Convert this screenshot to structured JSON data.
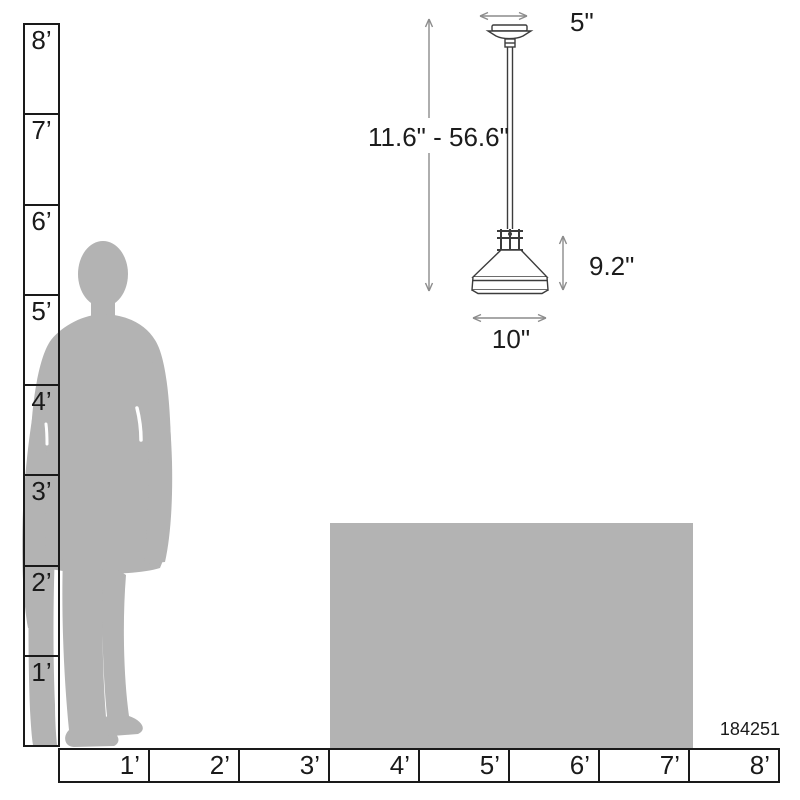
{
  "diagram": {
    "type": "product-scale-dimensions",
    "product": {
      "kind": "pendant-light-fixture",
      "model_number": "184251"
    },
    "annotations": {
      "canopy_width": "5\"",
      "hanging_height_range": "11.6\" - 56.6\"",
      "shade_height": "9.2\"",
      "shade_width": "10\""
    },
    "rulers": {
      "unit": "feet",
      "vertical": {
        "labels": [
          "8’",
          "7’",
          "6’",
          "5’",
          "4’",
          "3’",
          "2’",
          "1’"
        ],
        "range_feet": [
          0,
          8
        ]
      },
      "horizontal": {
        "labels": [
          "1’",
          "2’",
          "3’",
          "4’",
          "5’",
          "6’",
          "7’",
          "8’"
        ],
        "range_feet": [
          0,
          8
        ]
      }
    },
    "reference_figures": {
      "person": "standing-man-silhouette",
      "box": "scale-reference-box"
    },
    "colors": {
      "background": "#ffffff",
      "ruler_line": "#1a1a1a",
      "silhouette_gray": "#b3b3b3",
      "fixture_line": "#3c3c3c",
      "dimension_line": "#8c8c8c",
      "text": "#1c1c1c"
    }
  }
}
